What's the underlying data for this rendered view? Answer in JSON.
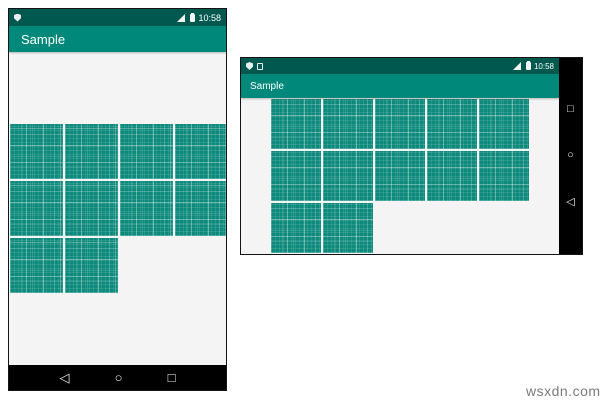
{
  "colors": {
    "status_bar": "#00584f",
    "app_bar": "#00897b",
    "tile": "#0e8a7c",
    "nav_bar": "#000000",
    "content_bg": "#f4f4f4"
  },
  "portrait": {
    "app_title": "Sample",
    "status_time": "10:58",
    "grid": {
      "columns": 4,
      "rows": [
        4,
        4,
        2
      ]
    },
    "nav": {
      "back": "◁",
      "home": "○",
      "recents": "□"
    }
  },
  "landscape": {
    "app_title": "Sample",
    "status_time": "10:58",
    "grid": {
      "columns": 5,
      "rows": [
        5,
        5,
        2
      ]
    },
    "nav": {
      "back": "◁",
      "home": "○",
      "recents": "□"
    }
  },
  "watermark": "wsxdn.com"
}
